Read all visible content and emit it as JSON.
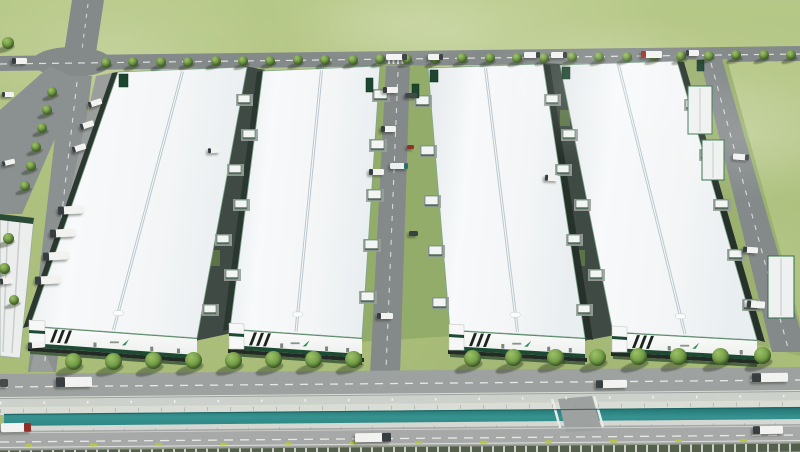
{
  "meta": {
    "description": "Aerial 3D architectural rendering of a logistics industrial park: four long white warehouse buildings with skylight ridges and green-trimmed facades, internal dock corridors with trucks, tree-lined frontage road, drainage canal and perimeter highway in the foreground, surrounded by open green fields."
  },
  "palette": {
    "grass": "#adc07d",
    "grass_dark": "#94ac69",
    "road": "#989c9a",
    "road_dark": "#84898a",
    "road_light": "#a6a9a7",
    "roof_white": "#f3f5f6",
    "facade_white": "#f8f9f8",
    "accent_green": "#1c4a32",
    "green_edge": "#437a57",
    "water_teal": "#2c8583",
    "tree_green": "#6f9a44",
    "truck_white": "#f2f3f1",
    "truck_red": "#9e2f26",
    "marking_yellow": "#b7c840",
    "fence_post": "#c9cdc6"
  },
  "buildings": [
    {
      "id": "warehouse-1",
      "roof": [
        [
          118,
          72
        ],
        [
          247,
          67
        ],
        [
          197,
          338
        ],
        [
          30,
          326
        ]
      ],
      "facade_h": 21,
      "tower_w": 15,
      "wall": "left",
      "logo": {
        "icon": "brand-swoosh-icon",
        "color": "#2f8d58"
      }
    },
    {
      "id": "warehouse-2",
      "roof": [
        [
          263,
          71
        ],
        [
          380,
          66
        ],
        [
          362,
          338
        ],
        [
          230,
          329
        ]
      ],
      "facade_h": 20,
      "tower_w": 14,
      "wall": "left",
      "logo": {
        "icon": "brand-swoosh-icon",
        "color": "#2f8d58"
      }
    },
    {
      "id": "warehouse-3",
      "roof": [
        [
          428,
          68
        ],
        [
          543,
          64
        ],
        [
          585,
          338
        ],
        [
          450,
          330
        ]
      ],
      "facade_h": 20,
      "tower_w": 14,
      "wall": "right",
      "logo": {
        "icon": "brand-swoosh-icon",
        "color": "#2f8d58"
      }
    },
    {
      "id": "warehouse-4",
      "roof": [
        [
          560,
          65
        ],
        [
          677,
          61
        ],
        [
          757,
          340
        ],
        [
          613,
          332
        ]
      ],
      "facade_h": 20,
      "tower_w": 14,
      "wall": "right",
      "logo": {
        "icon": "brand-swoosh-icon",
        "color": "#2f8d58"
      }
    }
  ],
  "props": {
    "docks": [
      {
        "x": 374,
        "y": 90
      },
      {
        "x": 371,
        "y": 140
      },
      {
        "x": 368,
        "y": 190
      },
      {
        "x": 365,
        "y": 240
      },
      {
        "x": 361,
        "y": 292
      },
      {
        "x": 416,
        "y": 96
      },
      {
        "x": 421,
        "y": 146
      },
      {
        "x": 425,
        "y": 196
      },
      {
        "x": 429,
        "y": 246
      },
      {
        "x": 433,
        "y": 298
      },
      {
        "x": 238,
        "y": 95,
        "w": 12,
        "h": 9
      },
      {
        "x": 243,
        "y": 130,
        "w": 12,
        "h": 9
      },
      {
        "x": 229,
        "y": 165,
        "w": 12,
        "h": 9
      },
      {
        "x": 235,
        "y": 200,
        "w": 12,
        "h": 9
      },
      {
        "x": 217,
        "y": 235,
        "w": 12,
        "h": 9
      },
      {
        "x": 226,
        "y": 270,
        "w": 12,
        "h": 9
      },
      {
        "x": 204,
        "y": 305,
        "w": 12,
        "h": 9
      },
      {
        "x": 546,
        "y": 95,
        "w": 12,
        "h": 9
      },
      {
        "x": 563,
        "y": 130,
        "w": 12,
        "h": 9
      },
      {
        "x": 557,
        "y": 165,
        "w": 12,
        "h": 9
      },
      {
        "x": 576,
        "y": 200,
        "w": 12,
        "h": 9
      },
      {
        "x": 568,
        "y": 235,
        "w": 12,
        "h": 9
      },
      {
        "x": 590,
        "y": 270,
        "w": 12,
        "h": 9
      },
      {
        "x": 578,
        "y": 305,
        "w": 12,
        "h": 9
      },
      {
        "x": 686,
        "y": 100,
        "w": 13,
        "h": 9
      },
      {
        "x": 701,
        "y": 150,
        "w": 13,
        "h": 9
      },
      {
        "x": 715,
        "y": 200,
        "w": 13,
        "h": 9
      },
      {
        "x": 729,
        "y": 250,
        "w": 13,
        "h": 9
      },
      {
        "x": 744,
        "y": 300,
        "w": 13,
        "h": 9
      }
    ],
    "booths": [
      [
        119,
        74,
        9,
        13
      ],
      [
        366,
        78,
        7,
        14
      ],
      [
        412,
        84,
        7,
        14
      ],
      [
        430,
        70,
        8,
        12
      ],
      [
        562,
        67,
        8,
        12
      ],
      [
        697,
        60,
        7,
        11
      ]
    ],
    "canopies": [
      [
        688,
        86,
        24,
        48
      ],
      [
        702,
        140,
        22,
        40
      ],
      [
        768,
        256,
        26,
        62
      ]
    ]
  },
  "vegetation": {
    "rows": [
      {
        "name": "street-tree-north",
        "start": 106,
        "step": 27.4,
        "count": 26,
        "y": 62.5,
        "slope": -0.0113,
        "size": 10
      },
      {
        "name": "street-tree-front",
        "xs": [
          73,
          113,
          153,
          193,
          233,
          273,
          313,
          353,
          472,
          513,
          555,
          597,
          638,
          678,
          720,
          762
        ],
        "x0": 73,
        "y": 361.5,
        "slope": -0.008,
        "size": 17
      }
    ],
    "extra": [
      [
        8,
        43,
        12
      ],
      [
        52,
        92,
        10
      ],
      [
        47,
        110,
        10
      ],
      [
        42,
        128,
        10
      ],
      [
        36,
        147,
        10
      ],
      [
        31,
        166,
        10
      ],
      [
        25,
        186,
        10
      ],
      [
        8,
        238,
        11
      ],
      [
        4,
        268,
        11
      ],
      [
        14,
        300,
        10
      ]
    ]
  },
  "vehicles": [
    {
      "x": 12,
      "y": 58,
      "w": 15,
      "h": 6,
      "side": "left"
    },
    {
      "x": 386,
      "y": 54,
      "w": 21,
      "h": 6,
      "side": "right"
    },
    {
      "x": 428,
      "y": 54,
      "w": 15,
      "h": 6,
      "side": "right"
    },
    {
      "x": 524,
      "y": 52,
      "w": 16,
      "h": 6,
      "side": "right"
    },
    {
      "x": 551,
      "y": 52,
      "w": 16,
      "h": 6,
      "side": "right"
    },
    {
      "x": 641,
      "y": 51,
      "w": 21,
      "h": 7,
      "cab": "#9e2f26",
      "side": "left",
      "name": "truck-red-cab"
    },
    {
      "x": 686,
      "y": 50,
      "w": 13,
      "h": 6,
      "side": "left"
    },
    {
      "x": 88,
      "y": 100,
      "w": 14,
      "h": 6,
      "r": -18,
      "side": "left"
    },
    {
      "x": 80,
      "y": 122,
      "w": 14,
      "h": 6,
      "r": -18,
      "side": "left"
    },
    {
      "x": 72,
      "y": 145,
      "w": 14,
      "h": 6,
      "r": -18,
      "side": "left"
    },
    {
      "x": 58,
      "y": 206,
      "w": 27,
      "h": 8,
      "r": -3,
      "side": "left",
      "type": "tanker"
    },
    {
      "x": 50,
      "y": 229,
      "w": 27,
      "h": 8,
      "r": -3,
      "side": "left",
      "type": "tanker"
    },
    {
      "x": 43,
      "y": 252,
      "w": 27,
      "h": 8,
      "r": -3,
      "side": "left",
      "type": "tanker"
    },
    {
      "x": 35,
      "y": 276,
      "w": 27,
      "h": 8,
      "r": -3,
      "side": "left",
      "type": "tanker"
    },
    {
      "x": 28,
      "y": 342,
      "w": 16,
      "h": 6,
      "r": -4,
      "side": "left"
    },
    {
      "x": 2,
      "y": 92,
      "w": 12,
      "h": 5,
      "side": "left"
    },
    {
      "x": 2,
      "y": 160,
      "w": 13,
      "h": 5,
      "r": -14,
      "side": "left"
    },
    {
      "x": 0,
      "y": 278,
      "w": 13,
      "h": 6,
      "r": -6,
      "side": "left"
    },
    {
      "x": 208,
      "y": 148,
      "w": 12,
      "h": 5,
      "r": -3,
      "side": "left"
    },
    {
      "x": 383,
      "y": 87,
      "w": 15,
      "h": 6,
      "side": "left"
    },
    {
      "x": 405,
      "y": 93,
      "w": 12,
      "h": 5,
      "body": "#41484a",
      "cab": null,
      "name": "truck-dark"
    },
    {
      "x": 381,
      "y": 126,
      "w": 15,
      "h": 6,
      "side": "left"
    },
    {
      "x": 390,
      "y": 163,
      "w": 18,
      "h": 6,
      "body": "#e9f0ee",
      "cab": "#2e6d6d",
      "side": "right"
    },
    {
      "x": 407,
      "y": 145,
      "w": 7,
      "h": 4,
      "body": "#8e2f2a",
      "cab": null,
      "name": "car-red"
    },
    {
      "x": 369,
      "y": 169,
      "w": 15,
      "h": 6,
      "side": "left"
    },
    {
      "x": 409,
      "y": 231,
      "w": 9,
      "h": 5,
      "body": "#3a4143",
      "cab": null,
      "name": "car-dark"
    },
    {
      "x": 377,
      "y": 313,
      "w": 16,
      "h": 6,
      "side": "left"
    },
    {
      "x": 545,
      "y": 175,
      "w": 13,
      "h": 6,
      "r": 3,
      "side": "left"
    },
    {
      "x": 733,
      "y": 154,
      "w": 16,
      "h": 6,
      "r": 4,
      "side": "right"
    },
    {
      "x": 743,
      "y": 247,
      "w": 15,
      "h": 6,
      "r": 4,
      "side": "left"
    },
    {
      "x": 747,
      "y": 301,
      "w": 18,
      "h": 7,
      "r": 4,
      "side": "left"
    },
    {
      "x": 56,
      "y": 377,
      "w": 36,
      "h": 10,
      "r": -1,
      "side": "left"
    },
    {
      "x": 596,
      "y": 380,
      "w": 31,
      "h": 8,
      "r": -1,
      "side": "left"
    },
    {
      "x": 752,
      "y": 373,
      "w": 36,
      "h": 9,
      "r": -1,
      "side": "left"
    },
    {
      "x": 0,
      "y": 379,
      "w": 8,
      "h": 8,
      "body": "#474c4b",
      "cab": null,
      "name": "truck-dark"
    },
    {
      "x": 1,
      "y": 423,
      "w": 30,
      "h": 9,
      "r": -1,
      "cab": "#8e2f2a",
      "side": "right",
      "name": "truck-red-cab"
    },
    {
      "x": 355,
      "y": 433,
      "w": 36,
      "h": 9,
      "r": -1,
      "side": "right"
    },
    {
      "x": 753,
      "y": 426,
      "w": 30,
      "h": 8,
      "r": -1,
      "side": "left"
    }
  ]
}
